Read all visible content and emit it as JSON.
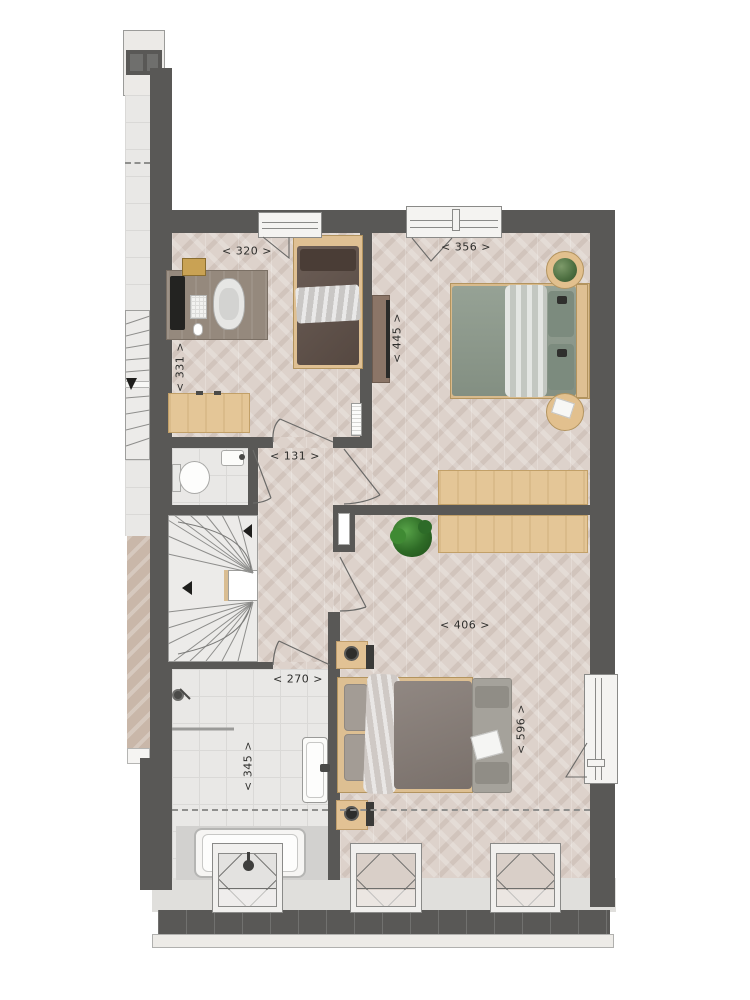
{
  "plan": {
    "dimensions": {
      "bedroom1_width": "< 320 >",
      "bedroom1_depth": "< 331 >",
      "bedroom2_width": "< 356 >",
      "bedroom2_depth": "< 445 >",
      "hallway_width": "< 131 >",
      "master_width": "< 406 >",
      "master_depth": "< 596 >",
      "bathroom_width": "< 270 >",
      "bathroom_depth": "< 345 >"
    },
    "colors": {
      "wall": "#595856",
      "wood_floor": "#ddd2cb",
      "tile_floor": "#e9e8e6",
      "furniture_wood": "#e4c697",
      "bed_green": "#8d9a8c",
      "bed_mauve": "#847a74",
      "bed_brown": "#5f5048",
      "plant_green": "#3f7d33"
    }
  }
}
